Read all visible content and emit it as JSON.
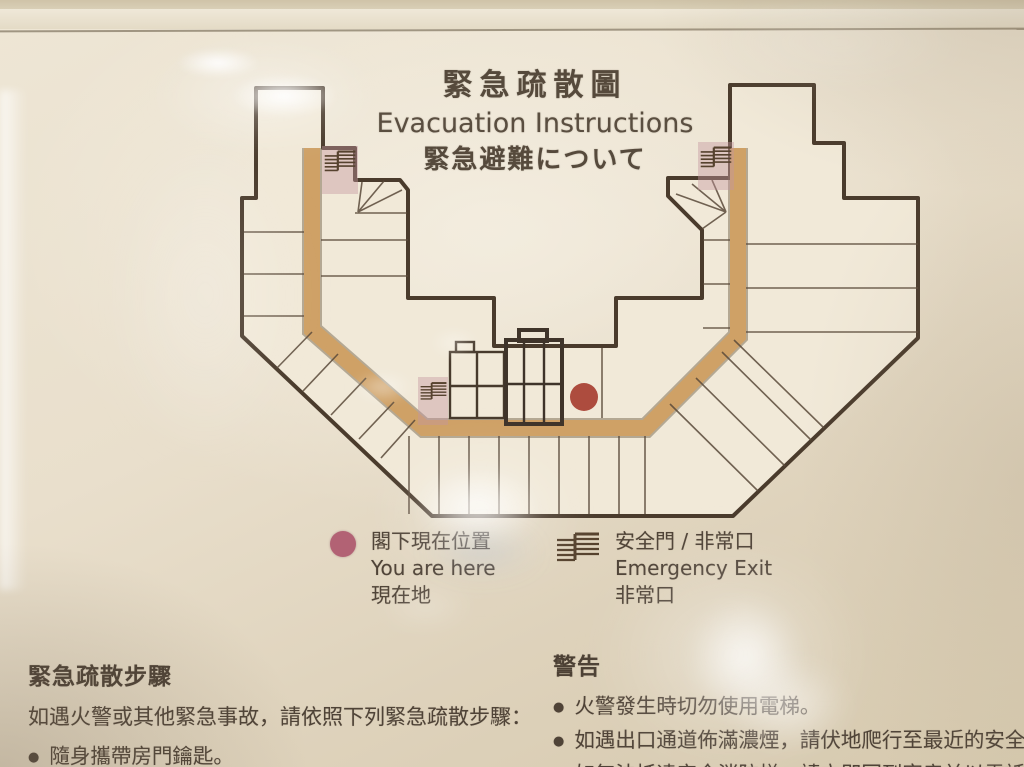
{
  "sign": {
    "title": {
      "zh": "緊急疏散圖",
      "en": "Evacuation Instructions",
      "ja": "緊急避難について"
    },
    "legend": {
      "you_are_here": {
        "zh": "閣下現在位置",
        "en": "You are here",
        "ja": "現在地"
      },
      "emergency_exit": {
        "zh": "安全門 / 非常口",
        "en": "Emergency Exit",
        "ja": "非常口"
      }
    },
    "procedures": {
      "heading": "緊急疏散步驟",
      "intro": "如遇火警或其他緊急事故，請依照下列緊急疏散步驟：",
      "items": [
        "隨身攜帶房門鑰匙。"
      ]
    },
    "warnings": {
      "heading": "警告",
      "items": [
        "火警發生時切勿使用電梯。",
        "如遇出口通道佈滿濃煙，請伏地爬行至最近的安全門",
        "如無法抵達安全消防梯，請立即回到客房並以電話撥"
      ]
    }
  },
  "map": {
    "marker": "you-are-here",
    "exit_icons": [
      "left-wing-stairs",
      "center-stairs",
      "right-wing-stairs"
    ]
  },
  "colors": {
    "outline": "#4a3b2c",
    "building_fill": "#f1e9d8",
    "corridor": "#cfa166",
    "corridor_edge": "#6b5940",
    "divider": "#5a4a3a",
    "dot_red": "#ad4c3e",
    "dot_pink": "#b26274",
    "exit_shade": "#c495a0",
    "text": "#4f4337",
    "background": "#e7ddc8"
  }
}
